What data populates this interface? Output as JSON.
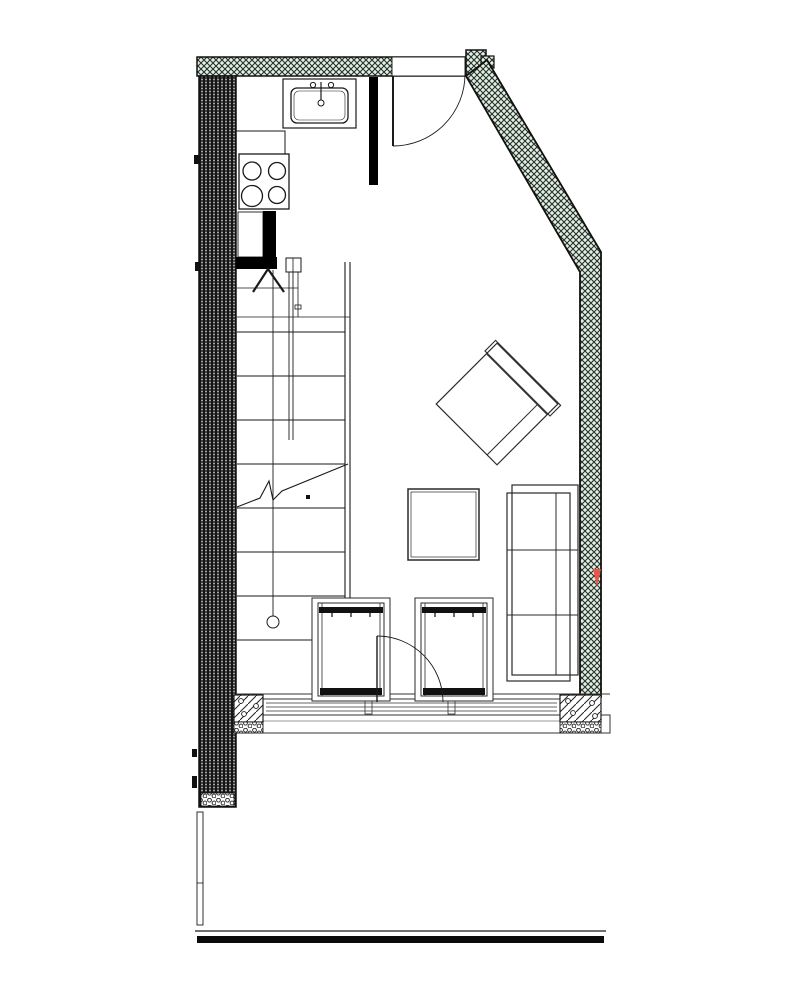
{
  "document": {
    "kind": "architectural floor plan (CAD line drawing, no visible text)",
    "visible_text": []
  },
  "colors": {
    "paper": "#ffffff",
    "ink": "#1a1a1a",
    "secondary_line": "#555555",
    "wall_green_fill": "#e3efe2",
    "wall_hatch_line": "#26302a",
    "wall_dark_fill": "#141414",
    "solid_wall": "#000000",
    "marker_red": "#e8564a"
  },
  "plan": {
    "walls": {
      "left": "thick stippled dark wall",
      "top": "green crosshatched wall with door opening",
      "diagonal_right": "green crosshatched sloped wall",
      "right": "green crosshatched wall with small red marker",
      "bottom": "glazed window wall with hatched corner piers and pebble bands"
    },
    "kitchen": {
      "sink": "counter-top sink with faucet",
      "cooktop_burners": 4,
      "niche": "small closet with solid black partition"
    },
    "stairs": {
      "full_treads": 8,
      "upper_landing_lines": 2,
      "center_line_with_circle": true,
      "break_line": true,
      "direction_arrow": "up"
    },
    "doors": {
      "entry_top": "90-degree swing door",
      "terrace_bottom": "90-degree swing door"
    },
    "furniture": [
      "armchair rotated 45 degrees",
      "square coffee table",
      "three-seat sofa against right wall",
      "chair with dark back bar (left)",
      "chair with dark back bar (right)"
    ],
    "deck": "double edge line with heavy black band at bottom"
  }
}
